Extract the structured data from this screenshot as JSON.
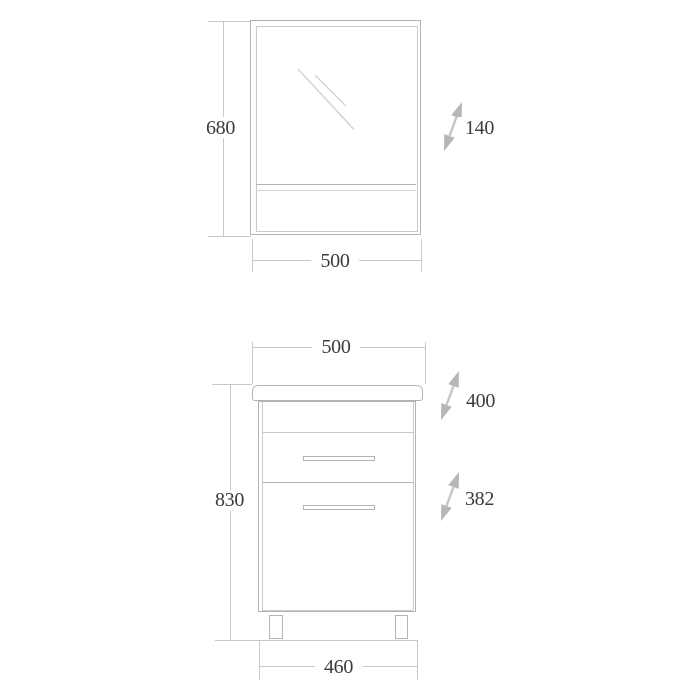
{
  "colors": {
    "line": "#b2b5b7",
    "line_light": "#c7cacb",
    "line_faint": "#d2d4d5",
    "dim": "#c6c8ca",
    "text": "#3c3c3c",
    "arrow": "#b4b7b9",
    "arrow_shaft": "#c3c6c8",
    "bg": "#ffffff"
  },
  "mirror_view": {
    "height": "680",
    "width": "500",
    "depth": "140"
  },
  "cabinet_view": {
    "width_top": "500",
    "height": "830",
    "worktop_depth": "400",
    "body_depth": "382",
    "width_base": "460"
  }
}
